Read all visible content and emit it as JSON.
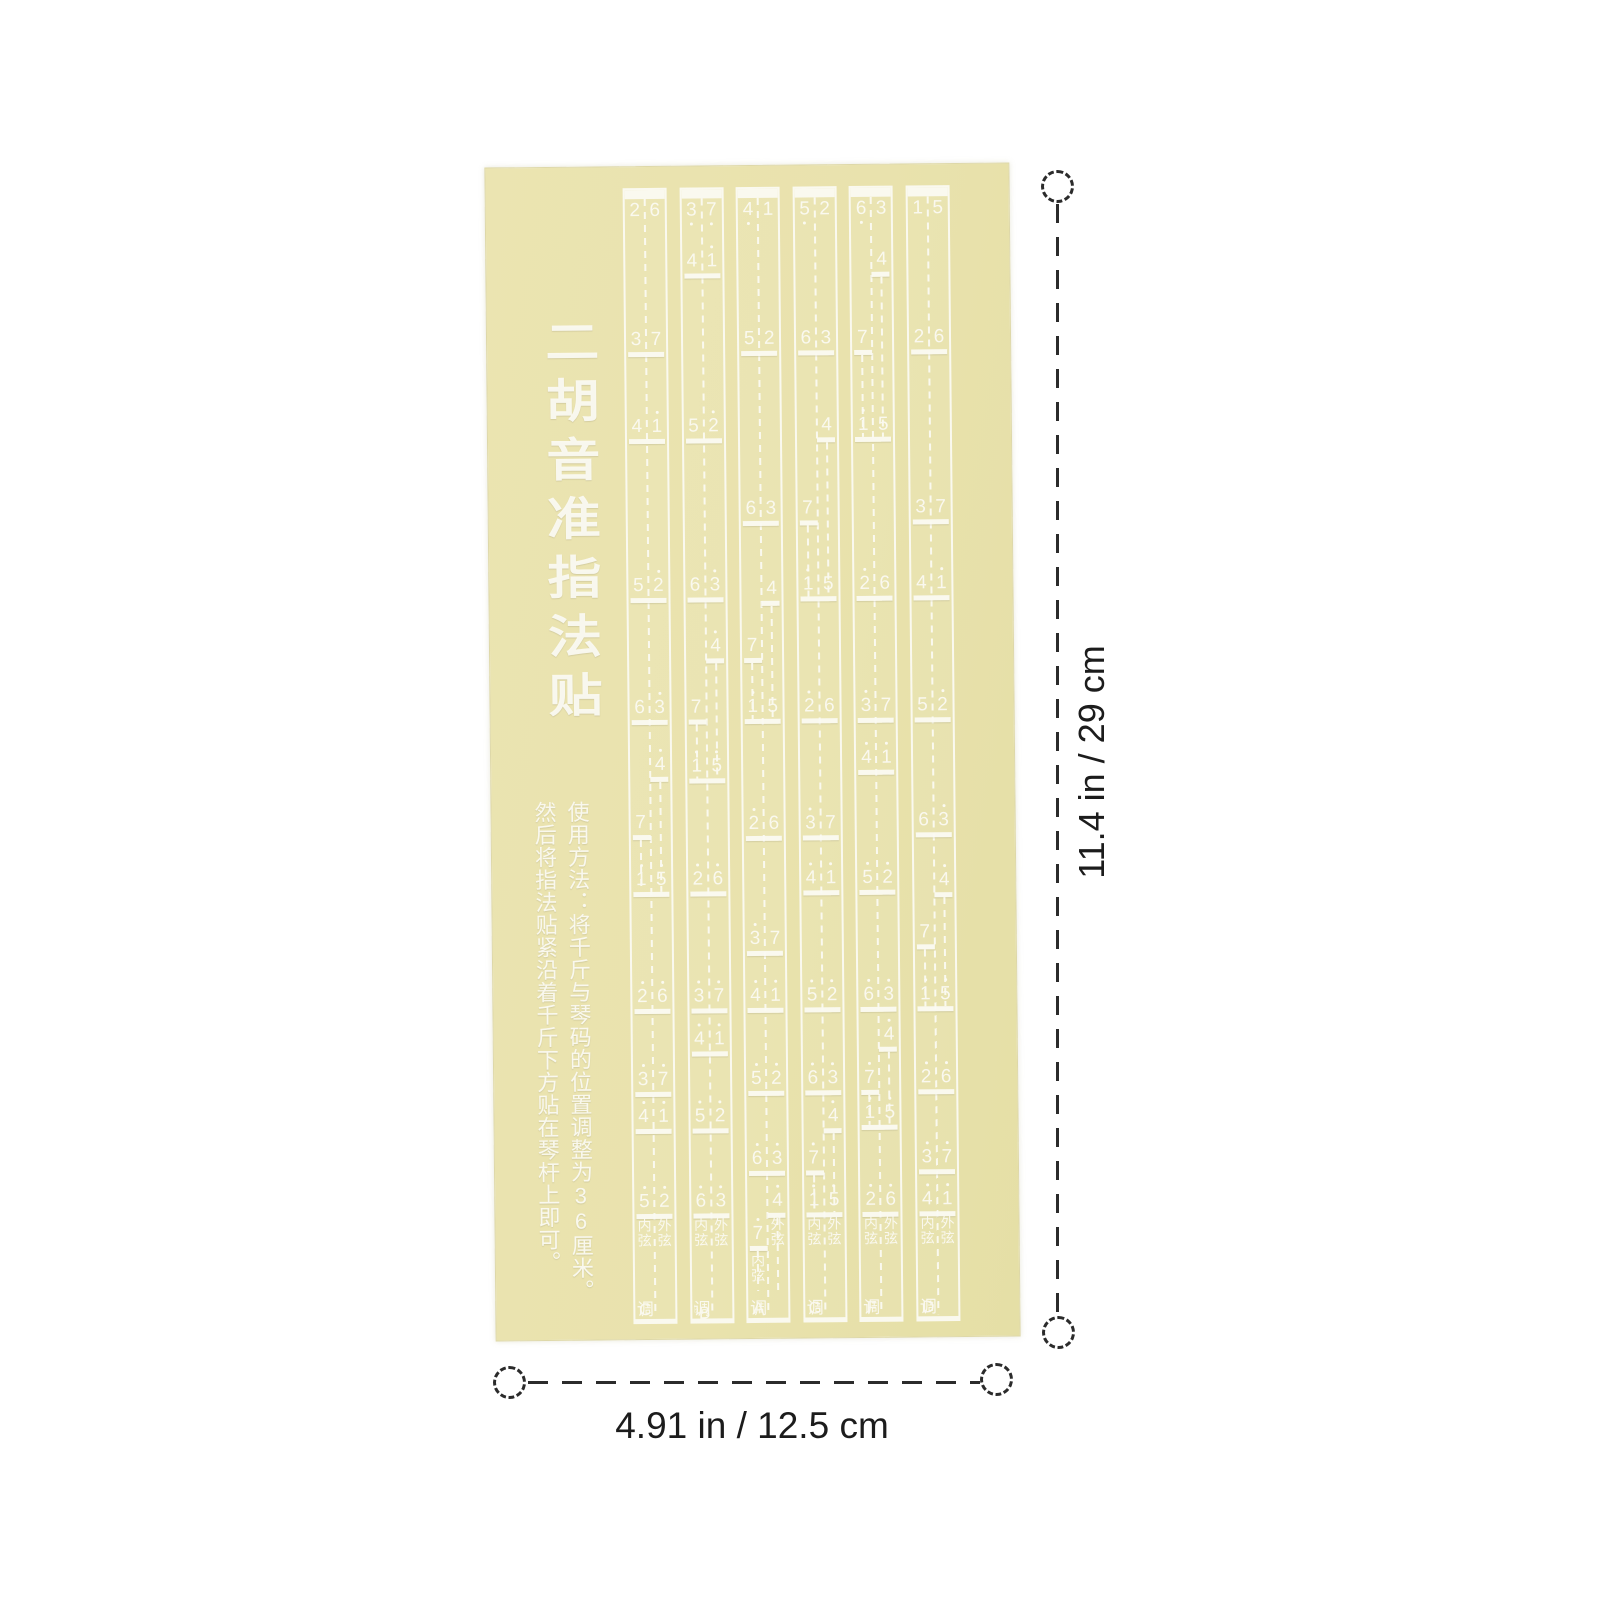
{
  "product": {
    "title": "二胡音准指法贴",
    "instructions": {
      "col1": "使用方法：将千斤与琴码的位置调整为36厘米。",
      "col2": "然后将指法贴紧沿着千斤下方贴在琴杆上即可。"
    },
    "labels": {
      "inner_string": "内弦",
      "outer_string": "外弦",
      "key_suffix": "调"
    },
    "strips": [
      {
        "key": "C",
        "open": [
          "2",
          "6"
        ],
        "rows": [
          [
            350,
            "3",
            "7"
          ],
          [
            437,
            "4",
            "1'"
          ],
          [
            596,
            "5",
            "2'"
          ],
          [
            718,
            "6",
            "3'"
          ],
          [
            775,
            null,
            "4'"
          ],
          [
            833,
            "7",
            null
          ],
          [
            890,
            "1'",
            "5'"
          ],
          [
            1007,
            "2'",
            "6'"
          ],
          [
            1090,
            "3'",
            "7'"
          ],
          [
            1127,
            "4'",
            "1'"
          ],
          [
            1212,
            "5'",
            "2'"
          ]
        ],
        "inner_label_y": 1216,
        "outer_label_y": 1216
      },
      {
        "key": "♭B",
        "open": [
          "3,",
          "7,"
        ],
        "rows": [
          [
            272,
            "4",
            "1'"
          ],
          [
            437,
            "5",
            "2'"
          ],
          [
            596,
            "6",
            "3'"
          ],
          [
            657,
            null,
            "4'"
          ],
          [
            718,
            "7",
            null
          ],
          [
            777,
            "1'",
            "5'"
          ],
          [
            890,
            "2'",
            "6'"
          ],
          [
            1007,
            "3'",
            "7'"
          ],
          [
            1050,
            "4'",
            "1'"
          ],
          [
            1127,
            "5'",
            "2'"
          ],
          [
            1212,
            "6'",
            "3'"
          ]
        ],
        "inner_label_y": 1216,
        "outer_label_y": 1216
      },
      {
        "key": "A",
        "open": [
          "4,",
          "1"
        ],
        "rows": [
          [
            350,
            "5",
            "2"
          ],
          [
            520,
            "6",
            "3"
          ],
          [
            600,
            null,
            "4"
          ],
          [
            657,
            "7",
            null
          ],
          [
            718,
            "1'",
            "5"
          ],
          [
            835,
            "2'",
            "6"
          ],
          [
            950,
            "3'",
            "7"
          ],
          [
            1007,
            "4'",
            "1'"
          ],
          [
            1090,
            "5'",
            "2'"
          ],
          [
            1170,
            "6'",
            "3'"
          ],
          [
            1212,
            null,
            "4'"
          ],
          [
            1245,
            "7'",
            null
          ]
        ],
        "inner_label_y": 1252,
        "outer_label_y": 1216
      },
      {
        "key": "G",
        "open": [
          "5,",
          "2"
        ],
        "rows": [
          [
            350,
            "6",
            "3"
          ],
          [
            437,
            null,
            "4"
          ],
          [
            520,
            "7",
            null
          ],
          [
            596,
            "1'",
            "5"
          ],
          [
            718,
            "2'",
            "6"
          ],
          [
            835,
            "3'",
            "7"
          ],
          [
            890,
            "4'",
            "1'"
          ],
          [
            1007,
            "5'",
            "2'"
          ],
          [
            1090,
            "6'",
            "3'"
          ],
          [
            1128,
            null,
            "4'"
          ],
          [
            1170,
            "7'",
            null
          ],
          [
            1212,
            "1'",
            "5'"
          ]
        ],
        "inner_label_y": 1216,
        "outer_label_y": 1216
      },
      {
        "key": "F",
        "open": [
          "6,",
          "3"
        ],
        "rows": [
          [
            272,
            null,
            "4"
          ],
          [
            350,
            "7",
            null
          ],
          [
            437,
            "1'",
            "5"
          ],
          [
            596,
            "2'",
            "6"
          ],
          [
            718,
            "3'",
            "7"
          ],
          [
            770,
            "4'",
            "1'"
          ],
          [
            890,
            "5'",
            "2'"
          ],
          [
            1007,
            "6'",
            "3'"
          ],
          [
            1047,
            null,
            "4'"
          ],
          [
            1090,
            "7'",
            null
          ],
          [
            1125,
            "1'",
            "5'"
          ],
          [
            1212,
            "2'",
            "6'"
          ]
        ],
        "inner_label_y": 1216,
        "outer_label_y": 1216
      },
      {
        "key": "D",
        "open": [
          "1",
          "5"
        ],
        "rows": [
          [
            350,
            "2",
            "6"
          ],
          [
            520,
            "3",
            "7"
          ],
          [
            596,
            "4",
            "1'"
          ],
          [
            718,
            "5",
            "2'"
          ],
          [
            833,
            "6",
            "3'"
          ],
          [
            893,
            null,
            "4'"
          ],
          [
            945,
            "7",
            null
          ],
          [
            1007,
            "1'",
            "5'"
          ],
          [
            1090,
            "2'",
            "6'"
          ],
          [
            1170,
            "3'",
            "7'"
          ],
          [
            1212,
            "4'",
            "1'"
          ]
        ],
        "inner_label_y": 1216,
        "outer_label_y": 1216
      }
    ]
  },
  "dimensions": {
    "height_label": "11.4 in / 29 cm",
    "width_label": "4.91 in / 12.5 cm"
  },
  "colors": {
    "sheet_yellow": "#e9e2ad",
    "print_white": "#f8f7ee",
    "annotation_dark": "#2b2b2b"
  }
}
